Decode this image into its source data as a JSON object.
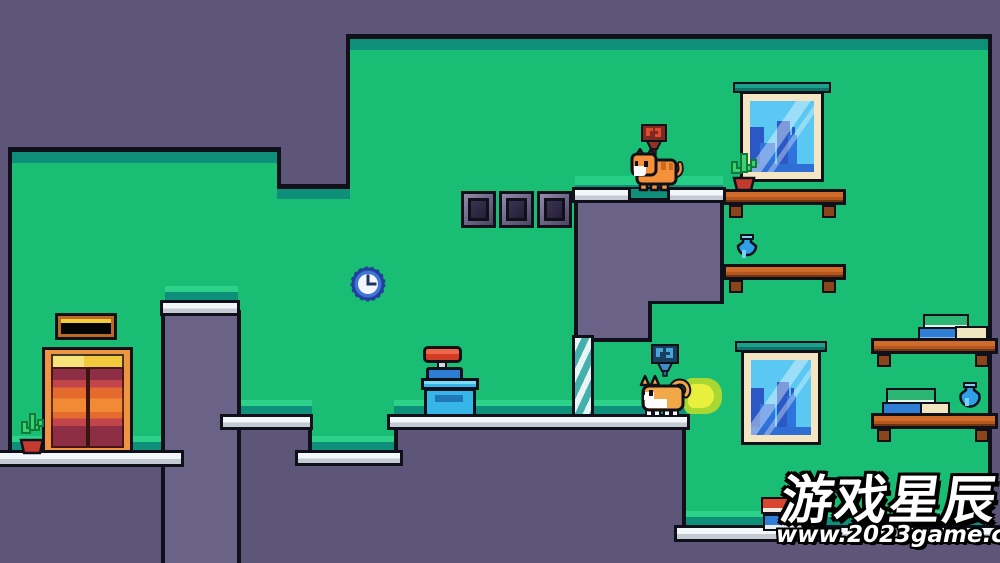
{
  "watermark": {
    "title": "游戏星辰",
    "url": "www.2023game.com"
  },
  "palette": {
    "background": "#5d5678",
    "wall_green": "#19bd74",
    "trim_teal": "#0e8f7a",
    "trim_light_green": "#2ed189",
    "outline_black": "#10101a",
    "ledge_white": "#f4f7fa",
    "pillar_purple": "#6a6387",
    "shelf_brown": "#d06c2a",
    "window_frame_cream": "#f4e6c3",
    "window_glass_blue": "#5ac8f2",
    "skyline_blue": "#2f74dc",
    "elevator_orange": "#ef9440",
    "elevator_gold": "#f2c93c",
    "cat_orange": "#f5913b",
    "cat_tan": "#f2a848",
    "trail_yellow": "#e8ef3c",
    "trail_green": "#a9d832",
    "marker_red": "#7c2a22",
    "marker_blue": "#17405e",
    "vase_blue": "#2f9fe8",
    "cactus_green": "#3ecf6e",
    "pot_red": "#c23b2e",
    "clock_blue": "#3f74d6",
    "pole_teal": "#43b0ac"
  },
  "entities": {
    "cats": [
      {
        "name": "orange-cat-idle",
        "state": "standing on upper platform",
        "x": 633,
        "y": 152,
        "marker": "red pixel flag"
      },
      {
        "name": "tan-cat-running",
        "state": "running with speed trail",
        "x": 641,
        "y": 374,
        "marker": "blue pixel flag"
      }
    ],
    "props": [
      "elevator with sign",
      "potted cactus (floor)",
      "wall clock showing 3:00",
      "three stone wall blocks",
      "striped support pole",
      "crate stack with red cap",
      "window with city view (upper)",
      "window with city view (lower)",
      "wall shelf with cactus",
      "wall shelf with vase",
      "shelf with book stack (upper right)",
      "shelf with books and vase (lower right)",
      "two books on floor"
    ]
  }
}
